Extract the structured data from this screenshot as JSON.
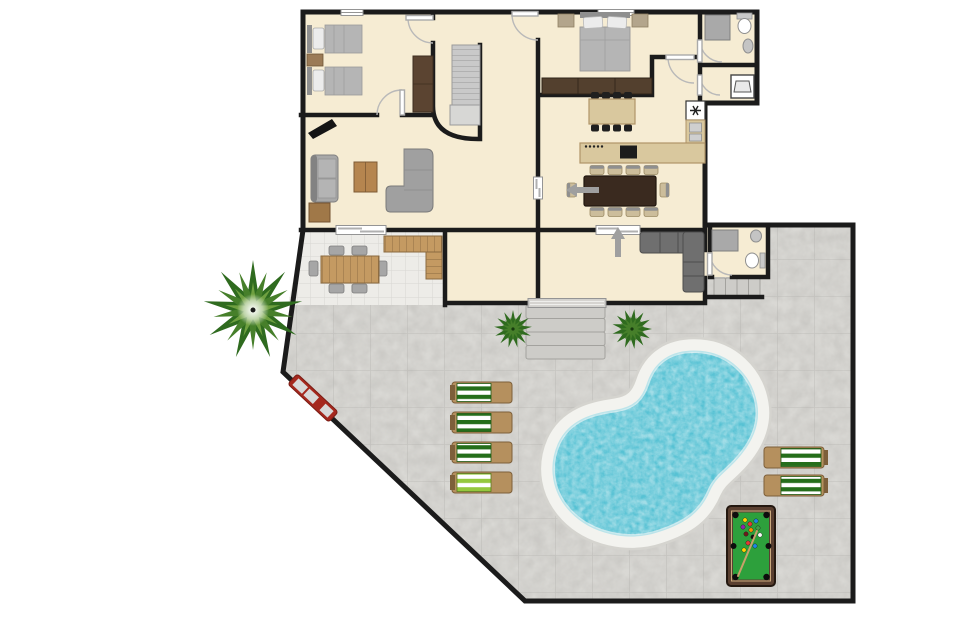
{
  "scene": {
    "kind": "residential floor plan with pool terrace",
    "canvas": {
      "width": 960,
      "height": 640
    }
  },
  "palette": {
    "wall": "#1b1b1b",
    "house_floor": "#f6ecd3",
    "patio_tile": "#edece8",
    "patio_line": "#d8d6d2",
    "stone": "#d9d8d4",
    "stone_line": "#c9c8c4",
    "pool_water": "#57c2d4",
    "pool_deck": "#f3f3ef",
    "pool_deck_edge": "#d5d4cf",
    "water_edge": "#bce4ea",
    "stair": "#c9c9c9",
    "stair_line": "#999999",
    "step": "#cdccc8",
    "step_edge": "#a3a29e",
    "door_arc": "#b9b9b9",
    "window_frame": "#949494",
    "arrow": "#9f9f9f",
    "sofa": "#a8a8a8",
    "sofa_dark": "#828282",
    "sectional": "#6f6f6f",
    "sectional_dark": "#4e4e4e",
    "bed_blanket": "#b5b5b5",
    "bed_pillow": "#ececec",
    "headboard": "#8f8f8f",
    "nightstand": "#9b7b57",
    "nightstand_gray": "#b3a58c",
    "wardrobe": "#5b4431",
    "dresser": "#53402e",
    "coffee_table": "#b5854f",
    "side_table": "#a07848",
    "patio_wood": "#c49a62",
    "wood_line": "#8a6a40",
    "island": "#d9c89e",
    "counter": "#d9c89e",
    "counter_edge": "#b09468",
    "cooktop": "#1c1c1c",
    "appliance": "#ffffff",
    "fixture": "#c4c4c4",
    "shower": "#a9a9a9",
    "table_dark": "#3a2a1f",
    "chair_tan": "#ccbd9b",
    "chair_top": "#8f8f8f",
    "stool": "#1f1f1f",
    "lounger_green": "#256e1b",
    "lounger_lime": "#94c83d",
    "lounger_wood": "#b5905e",
    "lounger_frame": "#7d5f3a",
    "bench_red": "#a5281e",
    "bench_pad": "#d8d8d8",
    "plant_dark": "#2f6b1f",
    "plant_mid": "#467f2a",
    "plant_light": "#6fa040",
    "felt": "#2da03c",
    "pool_frame": "#5a3f30",
    "cue": "#c8a06a"
  },
  "areas": {
    "bedroom_twin": "twin bedroom",
    "stair_hall": "stair hall",
    "living_room": "living room",
    "master_bedroom": "master bedroom",
    "bathroom_top": "bathroom",
    "laundry": "laundry room",
    "kitchen": "kitchen",
    "dining_room": "dining room",
    "family_room": "family room",
    "bathroom_side": "pool bathroom",
    "covered_patio": "covered patio",
    "backyard": "paved backyard",
    "pool": "kidney-shaped swimming pool"
  },
  "furniture": {
    "twin_beds": 2,
    "double_beds": 1,
    "sofas": 3,
    "bar_stools": 8,
    "dining_chairs": 10,
    "patio_chairs": 6,
    "sun_loungers": 6,
    "palm_trees": 1,
    "bushes": 2,
    "pool_tables": 1,
    "staircases": 1
  },
  "pool_table": {
    "balls": [
      "#ffd400",
      "#e53935",
      "#1e88e5",
      "#8e24aa",
      "#fb8c00",
      "#43a047",
      "#6d1b1b",
      "#111111",
      "#fafafa",
      "#e53935",
      "#1e88e5",
      "#ffd400"
    ]
  }
}
